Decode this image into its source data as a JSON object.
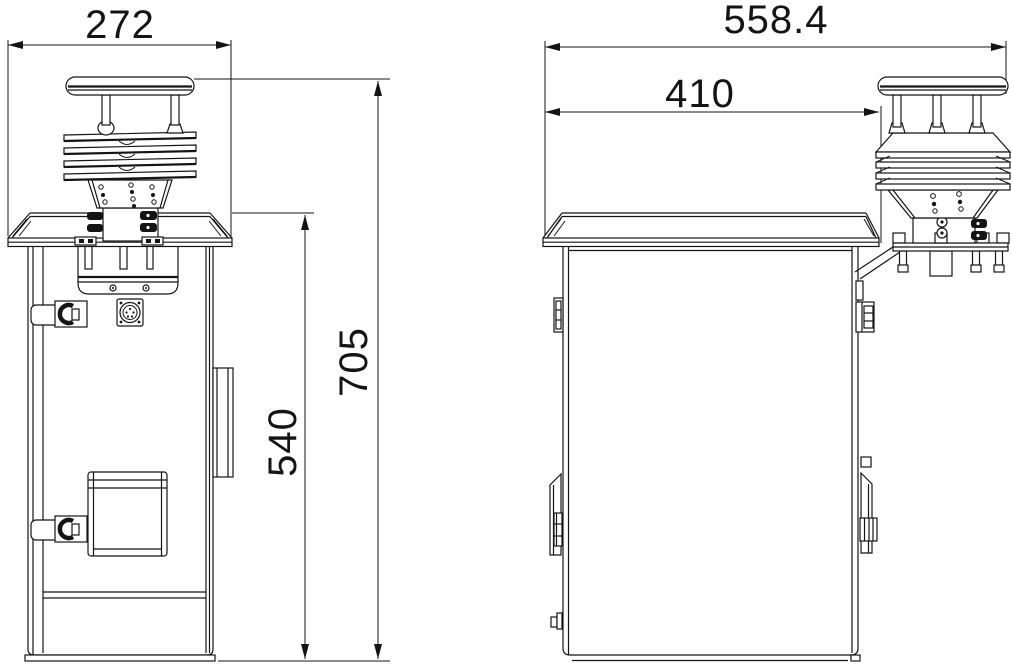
{
  "drawing": {
    "title": "weather-station-enclosure-two-view-dimensional-drawing",
    "background": "#ffffff",
    "line_color": "#141414",
    "views": {
      "front": {
        "name": "front-view",
        "dims": {
          "width": "272",
          "total_height": "705",
          "cabinet_height": "540"
        }
      },
      "side": {
        "name": "side-view",
        "dims": {
          "total_width": "558.4",
          "cabinet_width": "410"
        }
      }
    },
    "components": [
      "ultrasonic-anemometer-cap",
      "radiation-shield-louvers",
      "sensor-mount-block",
      "cabinet-roof",
      "cabinet-body",
      "door-latches",
      "circular-connector",
      "vent-panel",
      "mount-bracket",
      "support-strut"
    ]
  }
}
